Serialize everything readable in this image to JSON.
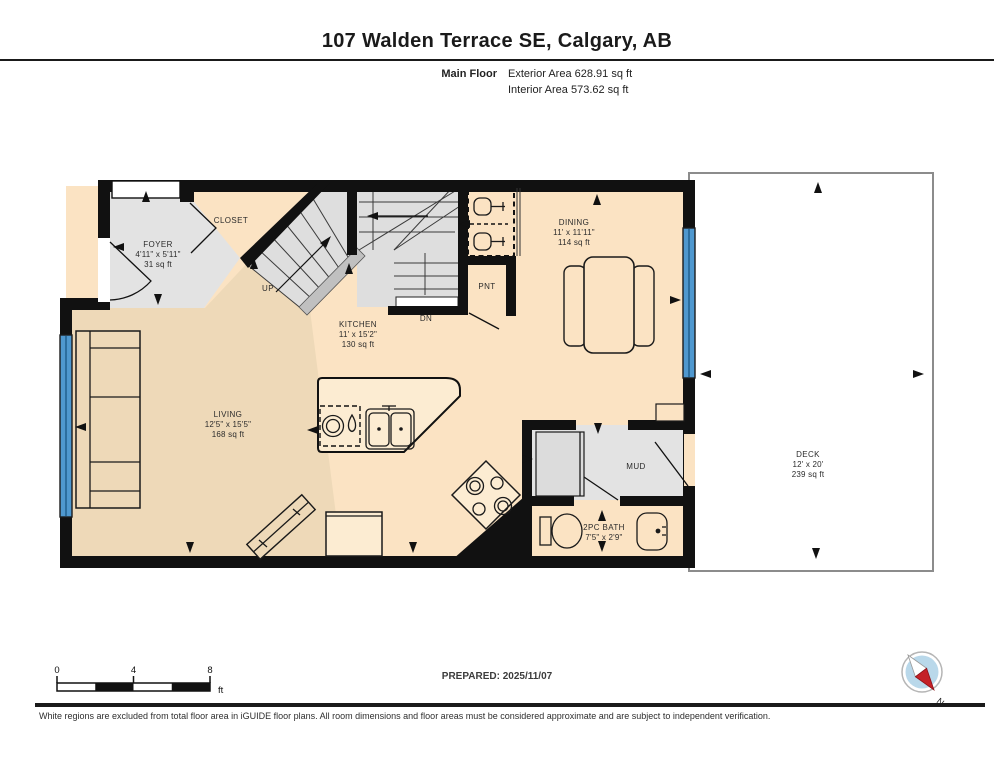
{
  "header": {
    "title": "107 Walden Terrace SE, Calgary, AB",
    "floor_label": "Main Floor",
    "exterior_area": "Exterior Area 628.91 sq ft",
    "interior_area": "Interior Area 573.62 sq ft"
  },
  "rooms": {
    "foyer": {
      "name": "FOYER",
      "dims": "4'11\" x 5'11\"",
      "area": "31 sq ft"
    },
    "closet": {
      "name": "CLOSET"
    },
    "kitchen": {
      "name": "KITCHEN",
      "dims": "11' x 15'2\"",
      "area": "130 sq ft"
    },
    "dining": {
      "name": "DINING",
      "dims": "11' x 11'11\"",
      "area": "114 sq ft"
    },
    "living": {
      "name": "LIVING",
      "dims": "12'5\" x 15'5\"",
      "area": "168 sq ft"
    },
    "pantry": {
      "name": "PNT"
    },
    "mud": {
      "name": "MUD"
    },
    "bath": {
      "name": "2PC BATH",
      "dims": "7'5\" x 2'9\""
    },
    "deck": {
      "name": "DECK",
      "dims": "12' x 20'",
      "area": "239 sq ft"
    }
  },
  "stairs": {
    "up": "UP",
    "down": "DN"
  },
  "scale_bar": {
    "start": "0",
    "mid": "4",
    "end": "8",
    "unit": "ft"
  },
  "prepared": "PREPARED: 2025/11/07",
  "compass": {
    "north_label": "N"
  },
  "footer": {
    "disclaimer": "White regions are excluded from total floor area in iGUIDE floor plans. All room dimensions and floor areas must be considered approximate and are subject to independent verification."
  },
  "colors": {
    "wall": "#111111",
    "floor_warm": "#fbe3c3",
    "floor_tan": "#eed9b8",
    "floor_gray": "#e3e3e3",
    "window_blue": "#4f98cf",
    "compass_red": "#c42127"
  }
}
